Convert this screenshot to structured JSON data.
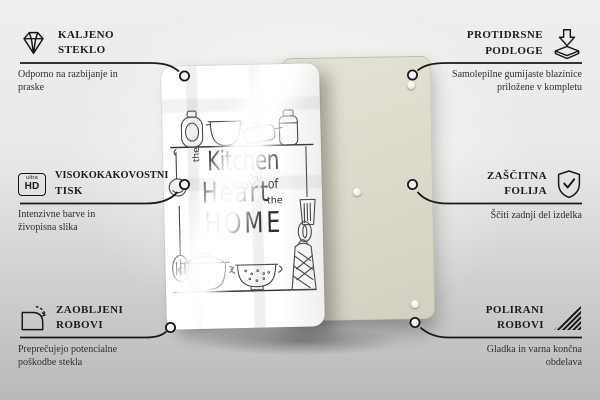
{
  "product": {
    "front_panel": {
      "description_name": "glass-front-with-print",
      "color": "#ffffff"
    },
    "back_panel": {
      "description_name": "back-cover",
      "color": "#dcdacb",
      "visible_pads": 3
    },
    "design_text": {
      "the_1": "the",
      "kitchen": "Kitchen",
      "is_the": "is the",
      "heart_symbol": "♡",
      "of": "of",
      "heart": "Heart",
      "the_2": "the",
      "home": "HOME"
    }
  },
  "features": [
    {
      "id": "kaljeno-steklo",
      "side": "left",
      "icon": "diamond-icon",
      "title_line1": "KALJENO",
      "title_line2": "STEKLO",
      "subtitle": "Odporno na razbijanje in praske"
    },
    {
      "id": "protidrsne-podloge",
      "side": "right",
      "icon": "anti-slip-pads-icon",
      "title_line1": "PROTIDRSNE",
      "title_line2": "PODLOGE",
      "subtitle": "Samolepilne gumijaste blazinice priložene v kompletu"
    },
    {
      "id": "visokokakovostni-tisk",
      "side": "left",
      "icon": "ultra-hd-icon",
      "icon_text_top": "ultra",
      "icon_text_bottom": "HD",
      "title_line1": "VISOKOKAKOVOSTNI",
      "title_line2": "TISK",
      "subtitle": "Intenzivne barve in živopisna slika"
    },
    {
      "id": "zascitna-folija",
      "side": "right",
      "icon": "shield-check-icon",
      "title_line1": "ZAŠČITNA",
      "title_line2": "FOLIJA",
      "subtitle": "Ščiti zadnji del izdelka"
    },
    {
      "id": "zaobljeni-robovi",
      "side": "left",
      "icon": "rounded-corner-icon",
      "title_line1": "ZAOBLJENI",
      "title_line2": "ROBOVI",
      "subtitle": "Preprečujejo potencialne poškodbe stekla"
    },
    {
      "id": "polirani-robovi",
      "side": "right",
      "icon": "polished-edge-icon",
      "title_line1": "POLIRANI",
      "title_line2": "ROBOVI",
      "subtitle": "Gladka in varna končna obdelava"
    }
  ],
  "colors": {
    "connector_line": "#191919",
    "title_text": "#1c1c1c",
    "subtitle_text": "#2e2e2e",
    "back_panel": "#dcdacb",
    "background_top": "#eeeeec",
    "background_bottom": "#b9b9b7"
  }
}
